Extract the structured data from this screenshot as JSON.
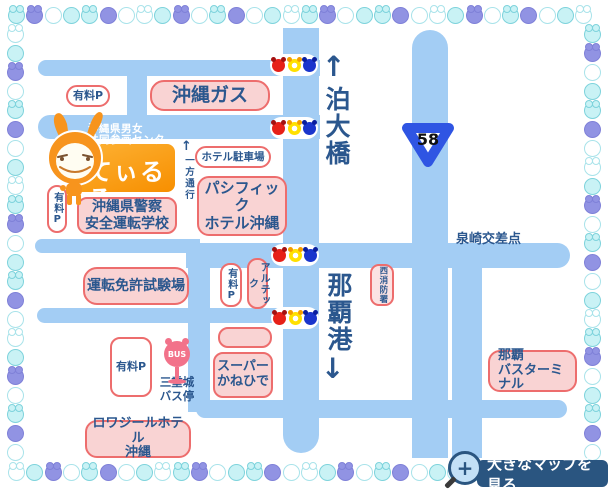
{
  "map": {
    "labels": {
      "tomari_bridge": "泊大橋",
      "naha_port": "那覇港",
      "izumizaki_intersection": "泉崎交差点",
      "route_number": "58",
      "one_way": "一方通行",
      "arrow_up": "↑",
      "arrow_down": "↓",
      "bus_stop_line1": "三重城",
      "bus_stop_line2": "バス停"
    },
    "places": {
      "paid_parking_top": "有料P",
      "okinawa_gas": "沖縄ガス",
      "center_line1": "沖縄県男女",
      "center_line2": "共同参画センター",
      "center_name": "てぃるる",
      "paid_parking_left": "有料P",
      "police_school_line1": "沖縄県警察",
      "police_school_line2": "安全運転学校",
      "hotel_parking": "ホテル駐車場",
      "pacific_hotel_line1": "パシフィック",
      "pacific_hotel_line2": "ホテル沖縄",
      "license_center": "運転免許試験場",
      "paid_parking_mid": "有料P",
      "artec": "アルテック",
      "fire_station": "西消防署",
      "super_kanehide_line1": "スーパー",
      "super_kanehide_line2": "かねひで",
      "paid_parking_bottom": "有料P",
      "bus_sign": "BUS",
      "naha_bus_terminal_line1": "那覇",
      "naha_bus_terminal_line2": "バスターミナル",
      "loisir_hotel_line1": "ロワジールホテル",
      "loisir_hotel_line2": "沖縄"
    },
    "button": {
      "view_large_map": "大きなマップを見る",
      "plus": "+"
    },
    "colors": {
      "road": "#A3CDF4",
      "text_navy": "#2B578E",
      "box_pink_fill": "#F9D3D3",
      "box_border": "#ED6D6D",
      "orange_box_top": "#FDB235",
      "orange_box_bottom": "#F78F00",
      "button_navy": "#2A5580",
      "signal_red": "#E62018",
      "signal_yellow": "#FFE000",
      "signal_blue": "#1A35CC",
      "bus_pink": "#F2728A",
      "route_shield_blue": "#2F55E3",
      "mascot_orange": "#F7941D"
    },
    "beads": {
      "styles": [
        {
          "key": "c",
          "fill": "#C9F2F5",
          "edge": "#7ED3DC"
        },
        {
          "key": "w",
          "fill": "#FFFFFF",
          "edge": "#A9E3EA"
        },
        {
          "key": "p",
          "fill": "#9193E3",
          "edge": "#7F81D8"
        }
      ],
      "pattern": [
        "c+",
        "p+",
        "w",
        "c",
        "c+",
        "p",
        "w",
        "w+",
        "c",
        "p+",
        "w",
        "c+",
        "p",
        "w",
        "c",
        "w+"
      ]
    }
  }
}
